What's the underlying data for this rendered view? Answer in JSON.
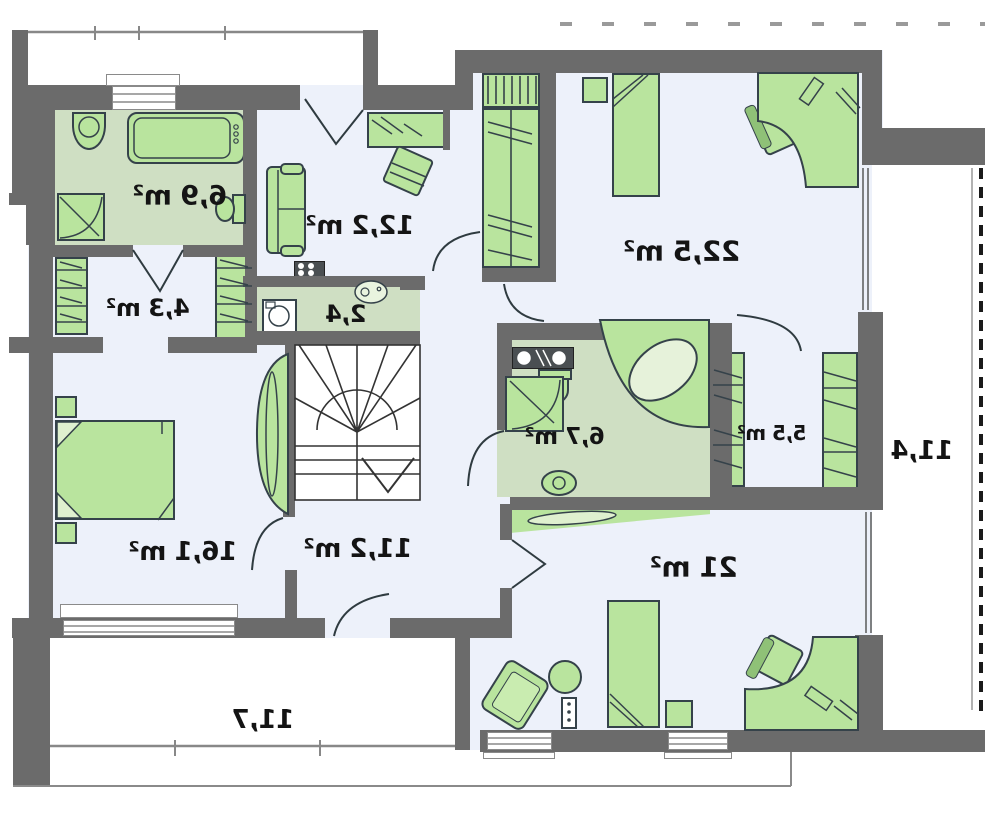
{
  "rooms": {
    "bath_main": {
      "label": "6,9 m²"
    },
    "closet_a": {
      "label": "4,3 m²"
    },
    "living": {
      "label": "12,2 m²"
    },
    "kitchen": {
      "label": "2,4"
    },
    "bedroom_large": {
      "label": "22,5 m²"
    },
    "bath_second": {
      "label": "6,7 m²"
    },
    "closet_b": {
      "label": "5,5 m²"
    },
    "bedroom_master": {
      "label": "16,1 m²"
    },
    "hall": {
      "label": "11,2 m²"
    },
    "bedroom_third": {
      "label": "21 m²"
    },
    "terrace_bottom": {
      "label": "11,7"
    },
    "terrace_side": {
      "label": "11,4"
    }
  },
  "colors": {
    "wall": "#6b6b6b",
    "room_floor": "#edf1fa",
    "wet_floor": "#cfdfc3",
    "furniture": "#b9e49e",
    "outline": "#35424a",
    "text": "#141414"
  }
}
